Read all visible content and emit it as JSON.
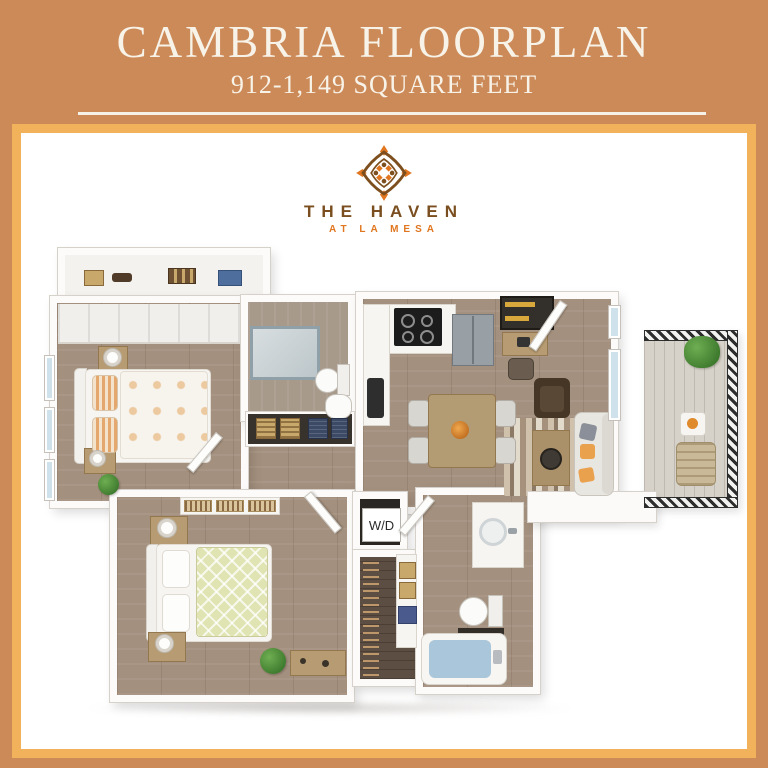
{
  "header": {
    "title": "CAMBRIA FLOORPLAN",
    "subtitle": "912-1,149 SQUARE FEET"
  },
  "logo": {
    "name": "THE HAVEN",
    "location": "AT LA MESA"
  },
  "floorplan": {
    "washer_dryer_label": "W/D"
  },
  "colors": {
    "frame_outer": "#cc8a59",
    "frame_inner_border": "#f2b25c",
    "header_text": "#f8f3e8",
    "logo_brown": "#7a4e1f",
    "logo_orange": "#e0761f",
    "floor_wood": "#a4907e",
    "closet_dark_wood": "#5c4e42",
    "accent_pillow_orange": "#e9a14e",
    "tub_water": "#a9c6da",
    "plant_green": "#4e8f3c",
    "railing_dark": "#2d2d2d"
  }
}
